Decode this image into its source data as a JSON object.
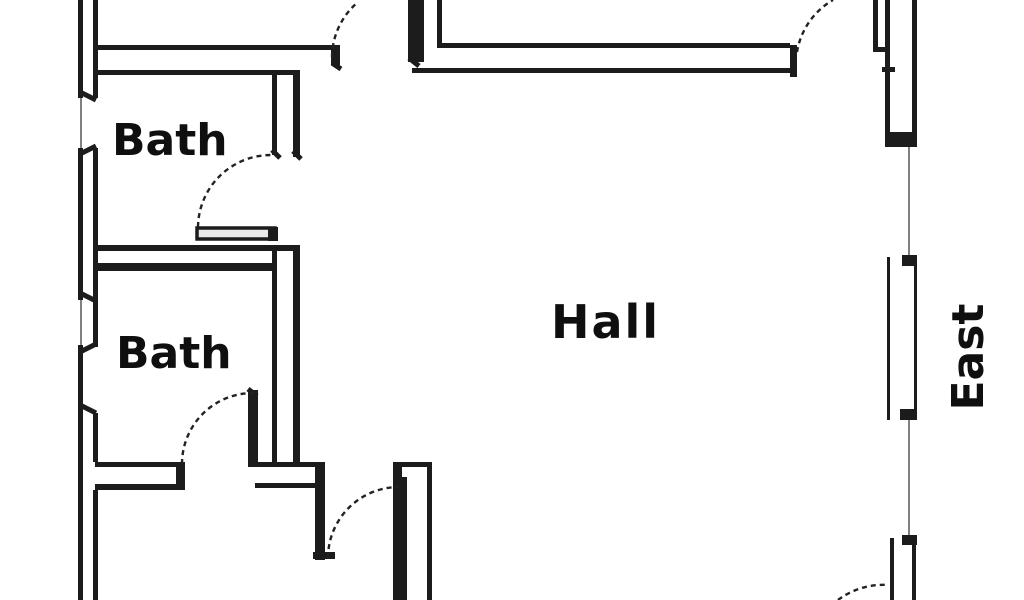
{
  "page": {
    "type": "architectural floor plan",
    "background_color": "#ffffff",
    "wall_color": "#1c1c1c",
    "window_line_color": "#808080",
    "door_arc_color": "#222222",
    "text_color": "#0f0f0f"
  },
  "labels": {
    "bath_top": "Bath",
    "bath_bottom": "Bath",
    "hall": "Hall",
    "compass_east": "East"
  }
}
